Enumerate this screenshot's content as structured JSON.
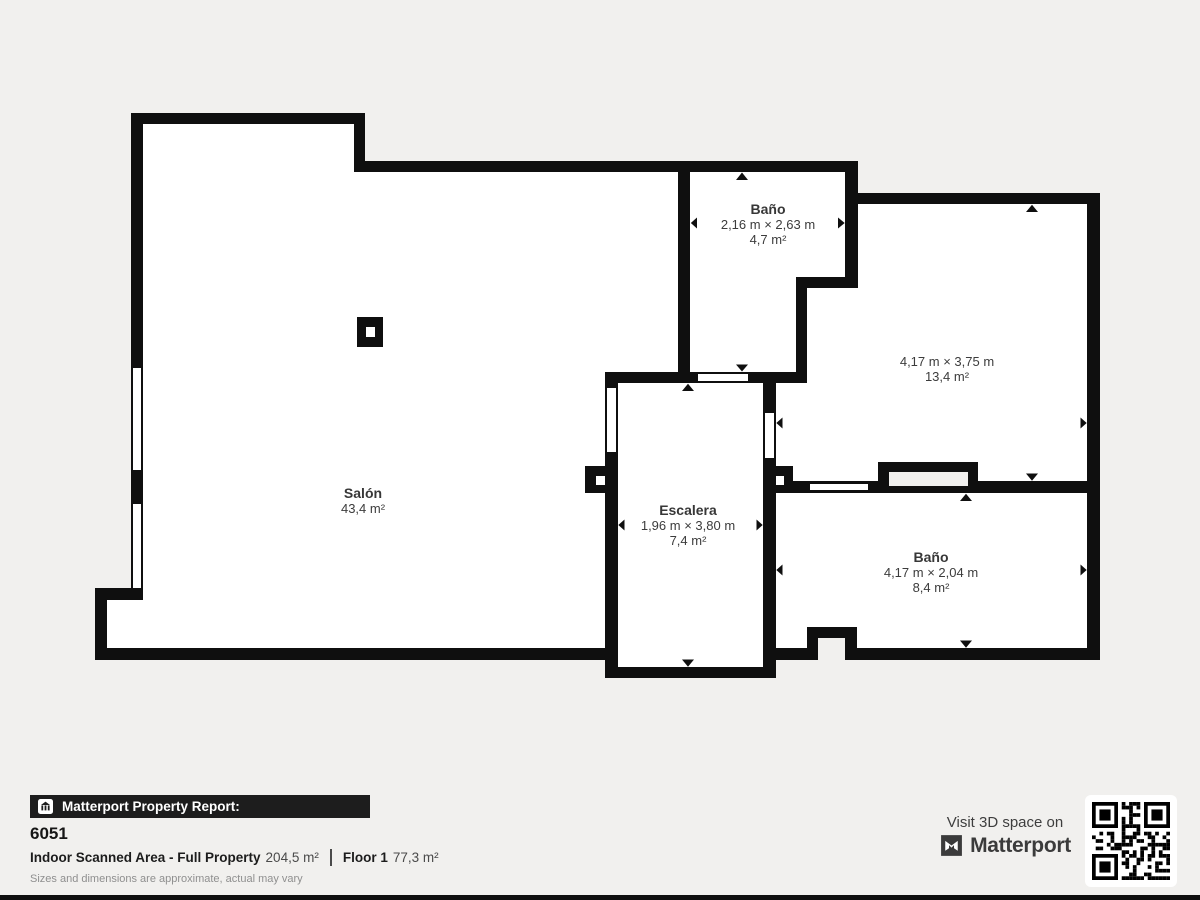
{
  "plan": {
    "rooms": [
      {
        "name": "Salón",
        "dims": "",
        "area": "43,4 m²"
      },
      {
        "name": "Baño",
        "dims": "2,16 m × 2,63 m",
        "area": "4,7 m²"
      },
      {
        "name": "",
        "dims": "4,17 m × 3,75 m",
        "area": "13,4 m²"
      },
      {
        "name": "Escalera",
        "dims": "1,96 m × 3,80 m",
        "area": "7,4 m²"
      },
      {
        "name": "Baño",
        "dims": "4,17 m × 2,04 m",
        "area": "8,4 m²"
      }
    ]
  },
  "footer": {
    "report_label": "Matterport Property Report:",
    "property_id": "6051",
    "scanned_area_label": "Indoor Scanned Area - Full Property",
    "scanned_area_value": "204,5 m²",
    "floor_label": "Floor 1",
    "floor_value": "77,3 m²",
    "disclaimer": "Sizes and dimensions are approximate, actual may vary",
    "visit_label": "Visit 3D space on",
    "brand": "Matterport"
  },
  "icons": {
    "report_badge": "building-icon",
    "brand_mark": "matterport-m-icon",
    "qr": "qr-code"
  },
  "colors": {
    "background": "#f1f0ee",
    "wall": "#0f0f0f",
    "room_fill": "#ffffff",
    "footer_bar": "#1d1d1d",
    "label_text": "#3c3c3c"
  }
}
